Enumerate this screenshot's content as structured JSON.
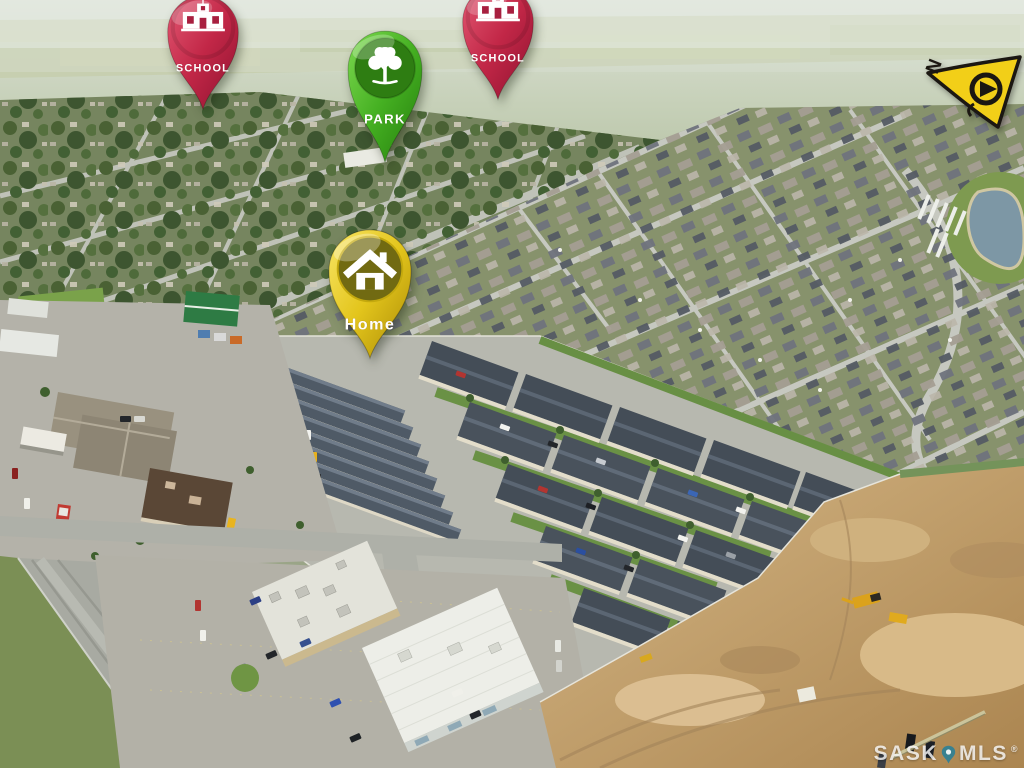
{
  "photo": {
    "kind_note": "aerial neighbourhood photo",
    "dominant_colors": [
      "#87926c",
      "#76855f",
      "#b7b8af",
      "#c2a474",
      "#cdd6c6"
    ]
  },
  "markers": [
    {
      "id": "school-west",
      "label": "SCHOOL",
      "icon": "school-building-icon",
      "color": "#c22747",
      "color_dark": "#8e1230"
    },
    {
      "id": "park",
      "label": "PARK",
      "icon": "park-tree-icon",
      "color": "#45b022",
      "color_dark": "#247d0c"
    },
    {
      "id": "school-east",
      "label": "SCHOOL",
      "icon": "school-building-icon",
      "color": "#c22747",
      "color_dark": "#8e1230"
    },
    {
      "id": "home",
      "label": "Home",
      "icon": "home-house-icon",
      "color": "#e3c51c",
      "color_dark": "#a98a06"
    }
  ],
  "compass": {
    "label": "N",
    "color": "#f2cf18",
    "outline": "#1b1712"
  },
  "watermark": {
    "prefix": "SASK",
    "suffix": "MLS",
    "registered": "®",
    "pin_color": "#2b7f97"
  }
}
